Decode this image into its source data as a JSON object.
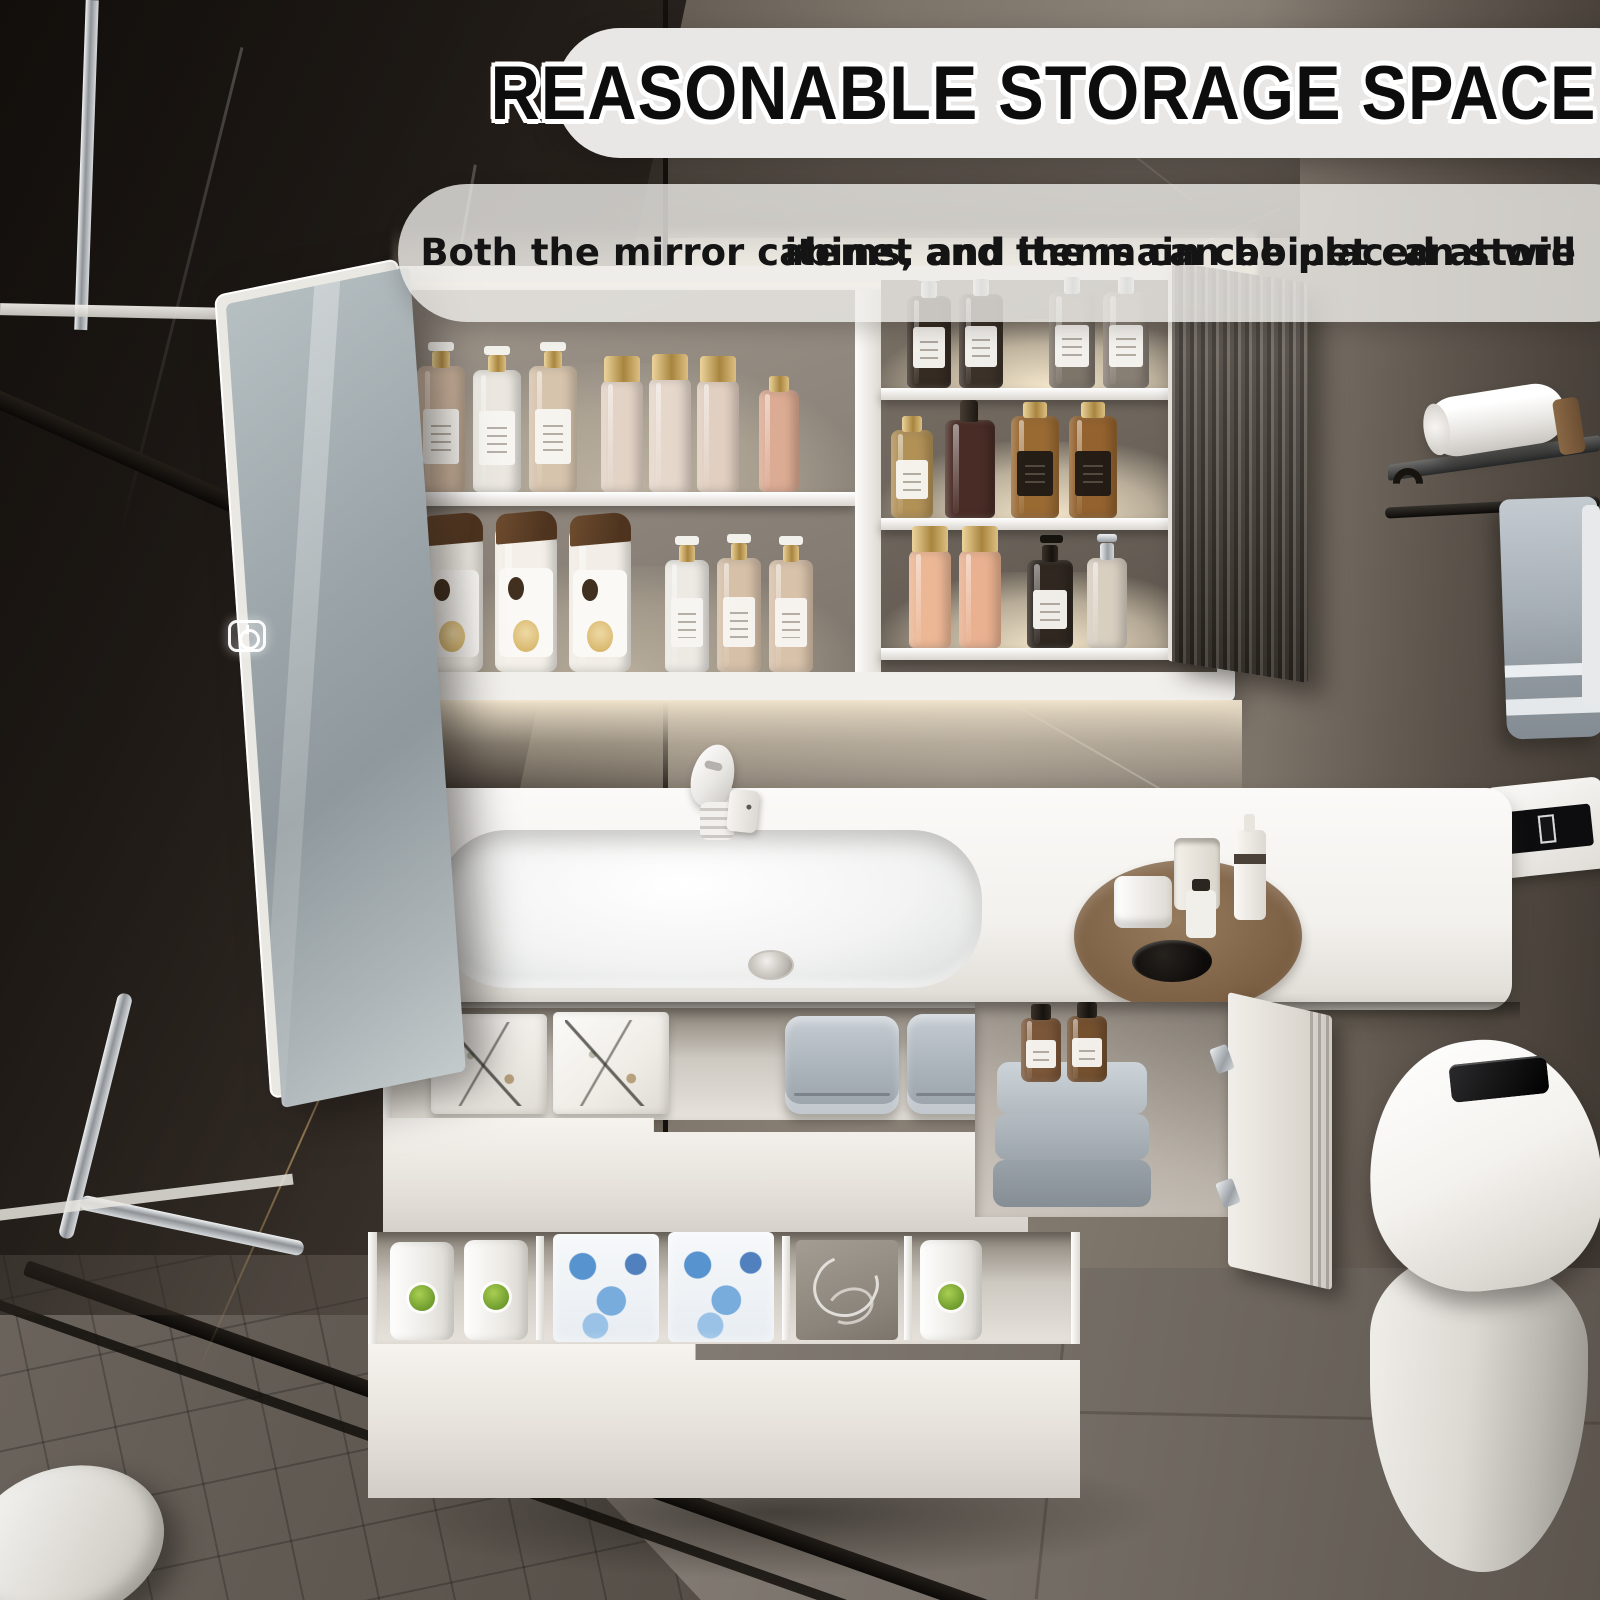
{
  "overlay": {
    "title": "REASONABLE STORAGE SPACE",
    "subtitle_line1": "Both the mirror cabinet and the main cabinet can store",
    "subtitle_line2": "items, and items can be placed at will"
  },
  "icons": {
    "mirror_touch_switch": "power-icon"
  },
  "palette": {
    "title_bg": "#e9e7e5",
    "subtitle_bg": "rgba(238,236,233,0.8)",
    "text_black": "#0d0d0d",
    "cabinet_white": "#f2f0ec",
    "interior_gray": "#8e867c",
    "led_warm_glow": "#f5e9d2",
    "counter_white": "#f7f5f1",
    "wall_taupe": "#8a8177",
    "wall_dark": "#2c2622",
    "floor_gray": "#7d766e",
    "mirror_glass": "#9aa4a8",
    "towel_gray": "#a8b0b7",
    "amber_bottle": "#94632f",
    "gold_cap": "#b9945c"
  },
  "mirror_cabinet": {
    "left_shelves": [
      {
        "bottles": [
          {
            "type": "pump",
            "x": 14,
            "w": 48,
            "h": 126,
            "body": "#cdb59e",
            "cap": "gold",
            "label": "light",
            "name": "lotion-pump-bottle"
          },
          {
            "type": "pump",
            "x": 70,
            "w": 48,
            "h": 122,
            "body": "#ebe7e0",
            "cap": "gold",
            "label": "light",
            "name": "lotion-pump-bottle"
          },
          {
            "type": "pump",
            "x": 126,
            "w": 48,
            "h": 126,
            "body": "#d7c4ad",
            "cap": "gold",
            "label": "light",
            "name": "lotion-pump-bottle"
          },
          {
            "type": "goldcap",
            "x": 198,
            "w": 42,
            "h": 112,
            "body": "#e3d3c6",
            "name": "toner-bottle"
          },
          {
            "type": "goldcap",
            "x": 246,
            "w": 42,
            "h": 114,
            "body": "#e6d7cb",
            "name": "toner-bottle"
          },
          {
            "type": "goldcap",
            "x": 294,
            "w": 42,
            "h": 112,
            "body": "#e1cfc1",
            "name": "toner-bottle"
          },
          {
            "type": "smallcap",
            "x": 356,
            "w": 40,
            "h": 102,
            "body": "#dcab93",
            "cap": "gold",
            "name": "pink-bottle"
          }
        ]
      },
      {
        "bottles": [
          {
            "type": "shampoo",
            "x": 18,
            "w": 62,
            "h": 146,
            "body": "#f4f0e9",
            "name": "shampoo-bottle"
          },
          {
            "type": "shampoo",
            "x": 92,
            "w": 62,
            "h": 148,
            "body": "#f4f0e9",
            "name": "shampoo-bottle"
          },
          {
            "type": "shampoo",
            "x": 166,
            "w": 62,
            "h": 146,
            "body": "#f2eee7",
            "name": "shampoo-bottle"
          },
          {
            "type": "pump",
            "x": 262,
            "w": 44,
            "h": 112,
            "body": "#edeae4",
            "cap": "gold",
            "label": "light",
            "name": "soap-pump-bottle"
          },
          {
            "type": "pump",
            "x": 314,
            "w": 44,
            "h": 114,
            "body": "#d6c0a8",
            "cap": "gold",
            "label": "light",
            "name": "soap-pump-bottle"
          },
          {
            "type": "pump",
            "x": 366,
            "w": 44,
            "h": 112,
            "body": "#d8c2aa",
            "cap": "gold",
            "label": "light",
            "name": "soap-pump-bottle"
          }
        ]
      }
    ],
    "right_shelves": [
      {
        "bottles": [
          {
            "type": "pump",
            "x": 26,
            "w": 44,
            "h": 92,
            "body": "#352b22",
            "cap": "silver",
            "label": "light",
            "name": "dark-pump-bottle"
          },
          {
            "type": "pump",
            "x": 78,
            "w": 44,
            "h": 94,
            "body": "#3b3128",
            "cap": "silver",
            "label": "light",
            "name": "dark-pump-bottle"
          },
          {
            "type": "pump",
            "x": 168,
            "w": 46,
            "h": 96,
            "body": "#7d746a",
            "cap": "silver",
            "label": "light",
            "name": "smoke-pump-bottle"
          },
          {
            "type": "pump",
            "x": 222,
            "w": 46,
            "h": 96,
            "body": "#877e74",
            "cap": "silver",
            "label": "light",
            "name": "smoke-pump-bottle"
          }
        ]
      },
      {
        "bottles": [
          {
            "type": "smallcap",
            "x": 10,
            "w": 42,
            "h": 88,
            "body": "#b29157",
            "cap": "gold",
            "label": "light",
            "name": "gold-perfume-bottle"
          },
          {
            "type": "spray",
            "x": 64,
            "w": 50,
            "h": 98,
            "body": "#492c25",
            "name": "maroon-spray-bottle"
          },
          {
            "type": "smallcap",
            "x": 130,
            "w": 48,
            "h": 102,
            "body": "#9a6a33",
            "cap": "gold",
            "label": "dark",
            "name": "amber-bottle"
          },
          {
            "type": "smallcap",
            "x": 188,
            "w": 48,
            "h": 102,
            "body": "#93622e",
            "cap": "gold",
            "label": "dark",
            "name": "amber-bottle"
          }
        ]
      },
      {
        "bottles": [
          {
            "type": "goldcap",
            "x": 28,
            "w": 42,
            "h": 98,
            "body": "#ecb795",
            "name": "peach-bottle"
          },
          {
            "type": "goldcap",
            "x": 78,
            "w": 42,
            "h": 98,
            "body": "#e9b190",
            "name": "peach-bottle"
          },
          {
            "type": "blackpump",
            "x": 146,
            "w": 46,
            "h": 88,
            "body": "#2f2720",
            "label": "light",
            "name": "black-pump-bottle"
          },
          {
            "type": "chromepump",
            "x": 206,
            "w": 40,
            "h": 90,
            "body": "#d9cfc1",
            "name": "cream-pump-bottle"
          }
        ]
      }
    ]
  },
  "vanity_drawers": {
    "top_drawer_items": [
      {
        "type": "inkbox",
        "x": 48,
        "y": 6,
        "w": 116,
        "h": 100,
        "name": "printed-storage-box"
      },
      {
        "type": "inkbox",
        "x": 170,
        "y": 4,
        "w": 116,
        "h": 102,
        "name": "printed-storage-box"
      },
      {
        "type": "towel",
        "x": 402,
        "y": 8,
        "w": 114,
        "h": 98,
        "name": "folded-towel"
      },
      {
        "type": "towel",
        "x": 524,
        "y": 6,
        "w": 114,
        "h": 100,
        "name": "folded-towel"
      }
    ],
    "bottom_drawer_items": [
      {
        "type": "gbottle",
        "x": 22,
        "y": 10,
        "w": 64,
        "h": 98,
        "name": "white-bottle-green-label"
      },
      {
        "type": "gbottle",
        "x": 96,
        "y": 8,
        "w": 64,
        "h": 100,
        "name": "white-bottle-green-label"
      },
      {
        "type": "tissue",
        "x": 185,
        "y": 2,
        "w": 106,
        "h": 108,
        "name": "tissue-pack"
      },
      {
        "type": "tissue",
        "x": 300,
        "y": 0,
        "w": 106,
        "h": 110,
        "name": "tissue-pack"
      },
      {
        "type": "cordbox",
        "x": 428,
        "y": 8,
        "w": 102,
        "h": 100,
        "name": "cable-organizer-box"
      },
      {
        "type": "gbottle",
        "x": 552,
        "y": 8,
        "w": 62,
        "h": 100,
        "name": "white-bottle-green-label"
      }
    ],
    "side_cabinet_items": [
      {
        "type": "amber",
        "x": 46,
        "y": 16,
        "w": 40,
        "h": 64,
        "body": "#7b5638",
        "label": "light",
        "name": "amber-bottle"
      },
      {
        "type": "amber",
        "x": 92,
        "y": 14,
        "w": 40,
        "h": 66,
        "body": "#74502f",
        "label": "light",
        "name": "amber-bottle"
      }
    ]
  }
}
